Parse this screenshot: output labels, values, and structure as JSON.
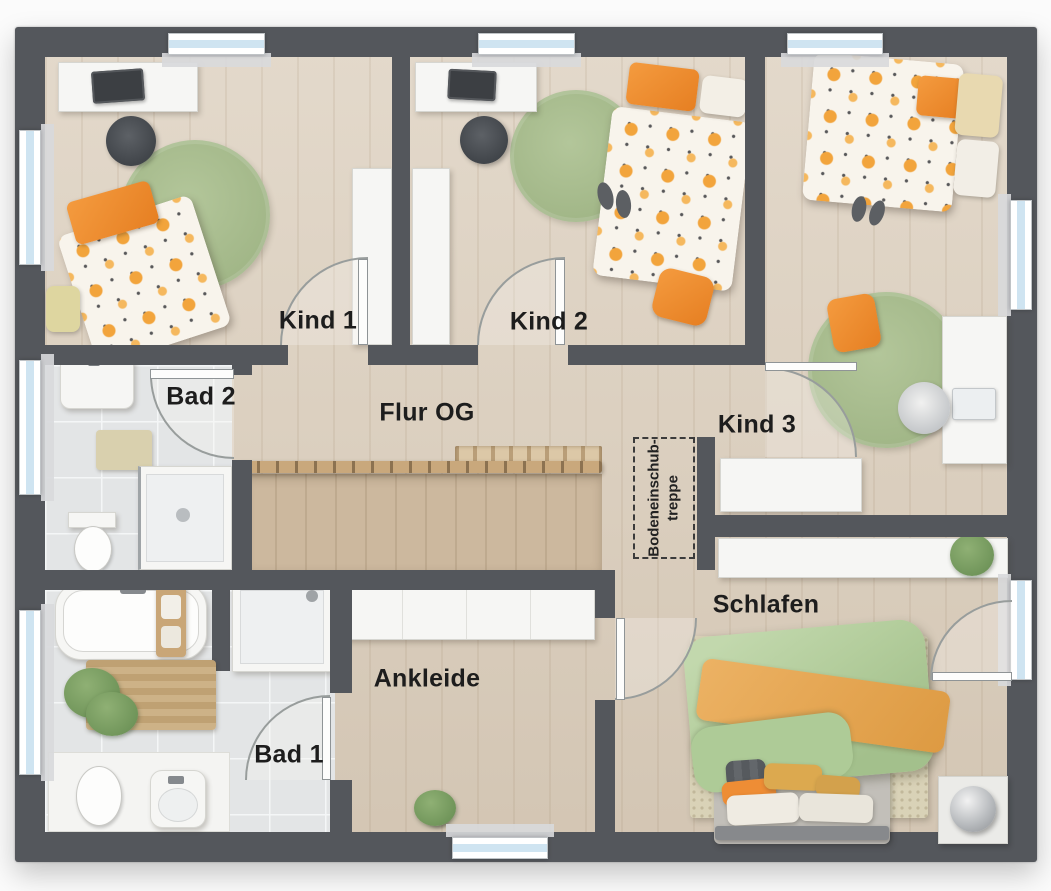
{
  "plan_type": "floor-plan",
  "rooms": [
    {
      "id": "kind-1",
      "label": "Kind 1"
    },
    {
      "id": "kind-2",
      "label": "Kind 2"
    },
    {
      "id": "kind-3",
      "label": "Kind 3"
    },
    {
      "id": "bad-2",
      "label": "Bad 2"
    },
    {
      "id": "flur-og",
      "label": "Flur OG"
    },
    {
      "id": "schlafen",
      "label": "Schlafen"
    },
    {
      "id": "ankleide",
      "label": "Ankleide"
    },
    {
      "id": "bad-1",
      "label": "Bad 1"
    }
  ],
  "annotations": {
    "attic_stairs": {
      "line1": "Bodeneinschub-",
      "line2": "treppe"
    }
  },
  "palette": {
    "wall": "#54575c",
    "wood_floor": "#dbcebc",
    "stairwell_wood": "#ccb89e",
    "tile_floor": "#e3e5e6",
    "accent_orange": "#ee8d33",
    "rug_green": "#a9bd8f",
    "bed_green": "#b7d0a0",
    "window_glass": "#cfe4f1",
    "label_text": "#1d1d1d"
  }
}
